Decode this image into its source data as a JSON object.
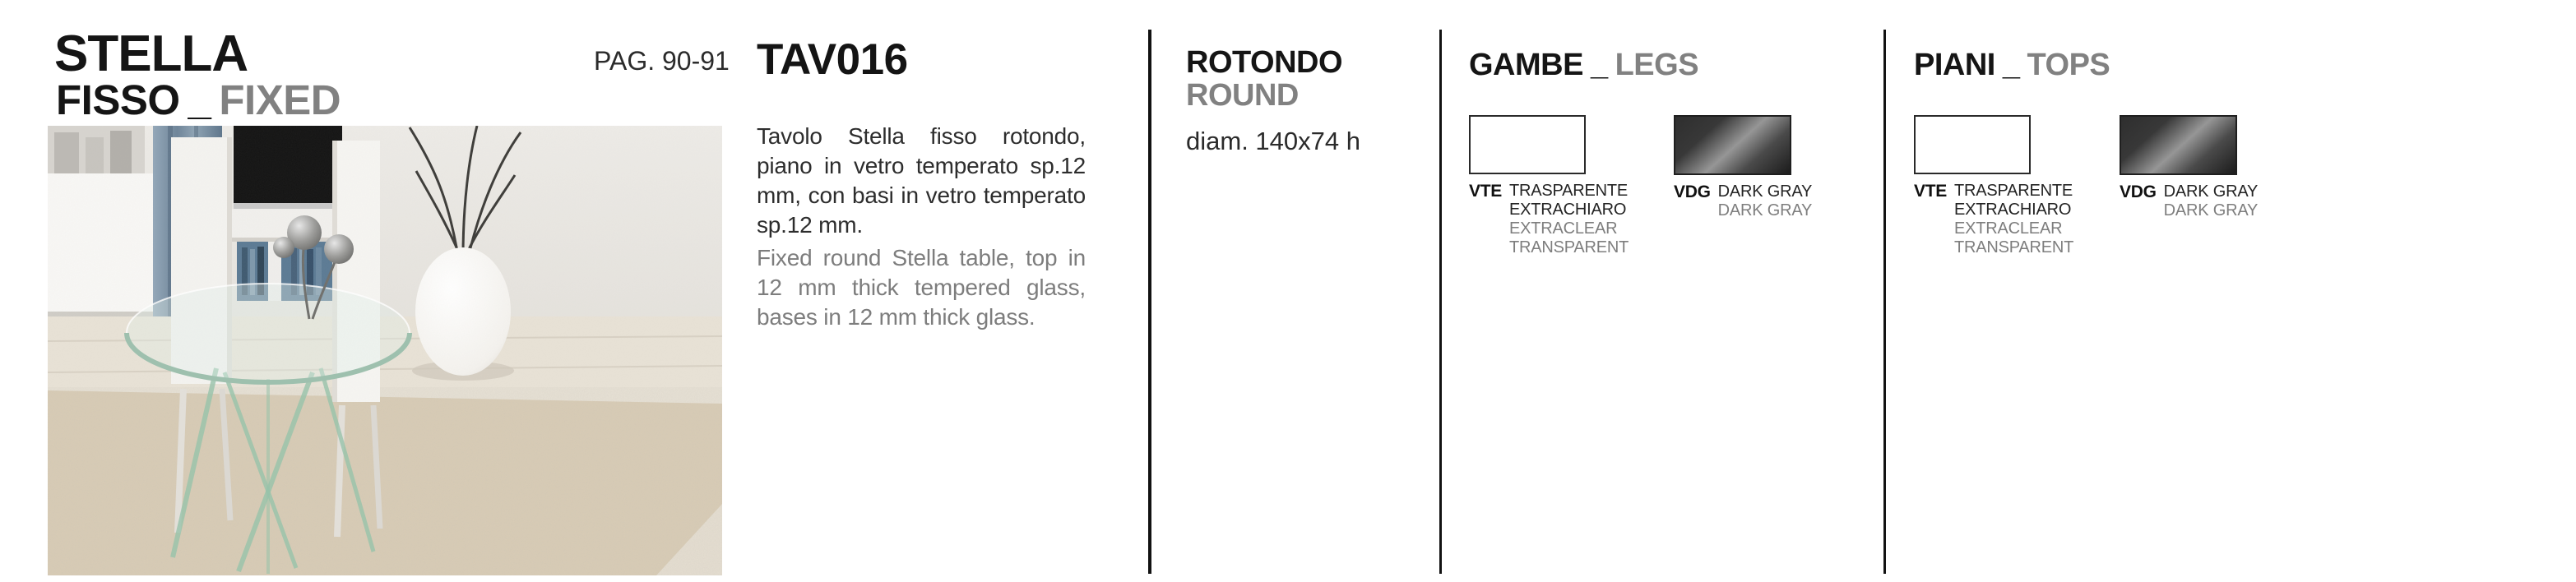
{
  "header": {
    "product_name": "STELLA",
    "variant_it": "FISSO",
    "separator": "_",
    "variant_en": "FIXED",
    "page_ref": "PAG. 90-91"
  },
  "photo": {
    "description": "Living room scene: round tempered-glass Stella table with crossed glass legs on a beige shag rug, white chairs, TV on white bench, white vase with branches"
  },
  "product": {
    "code": "TAV016",
    "description_it": "Tavolo Stella fisso rotondo, piano in vetro temperato sp.12 mm, con basi in vetro temperato sp.12 mm.",
    "description_en": "Fixed round Stella table, top in 12 mm thick tempered glass, bases in 12 mm thick glass."
  },
  "shape": {
    "label_it": "ROTONDO",
    "label_en": "ROUND",
    "dimensions": "diam. 140x74 h"
  },
  "legs": {
    "title_it": "GAMBE",
    "separator": "_",
    "title_en": "LEGS",
    "swatches": [
      {
        "code": "VTE",
        "line1_it": "TRASPARENTE",
        "line2_it": "EXTRACHIARO",
        "line1_en": "EXTRACLEAR",
        "line2_en": "TRANSPARENT",
        "fill": "extraclear-white"
      },
      {
        "code": "VDG",
        "line1_it": "DARK GRAY",
        "line1_en": "DARK GRAY",
        "fill": "dark-gray-gradient"
      }
    ]
  },
  "tops": {
    "title_it": "PIANI",
    "separator": "_",
    "title_en": "TOPS",
    "swatches": [
      {
        "code": "VTE",
        "line1_it": "TRASPARENTE",
        "line2_it": "EXTRACHIARO",
        "line1_en": "EXTRACLEAR",
        "line2_en": "TRANSPARENT",
        "fill": "extraclear-white"
      },
      {
        "code": "VDG",
        "line1_it": "DARK GRAY",
        "line1_en": "DARK GRAY",
        "fill": "dark-gray-gradient"
      }
    ]
  },
  "colors": {
    "text_black": "#151515",
    "text_gray": "#818181",
    "divider": "#121212",
    "dark_gray_swatch": "#3a3a3a"
  }
}
